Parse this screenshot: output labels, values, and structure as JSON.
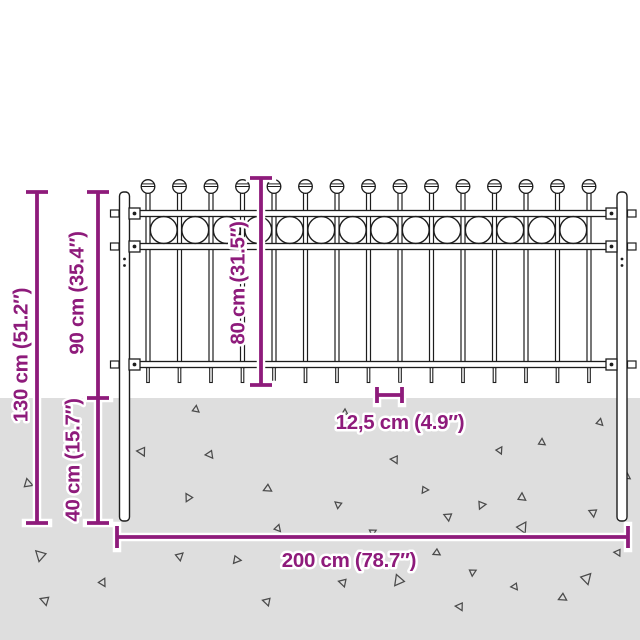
{
  "diagram": {
    "description": "Product dimension drawing of a steel fence panel with ball-top pickets, hoop ornaments, two ground posts and magenta measurement lines",
    "colors": {
      "dimension": "#8E1B7B",
      "outline": "#1d1d1d",
      "ground": "#dedede",
      "background": "#ffffff",
      "speck": "#4a4a4a"
    },
    "labels": {
      "total_height": "130 cm (51.2″)",
      "height_above_ground": "90 cm (35.4″)",
      "panel_height": "80 cm (31.5″)",
      "depth_below_ground": "40 cm (15.7″)",
      "picket_spacing": "12,5 cm (4.9″)",
      "total_width": "200 cm (78.7″)"
    },
    "ground": {
      "top": 398
    },
    "fence": {
      "picket_count": 15,
      "first_picket_x": 148,
      "picket_spacing_px": 31.5,
      "picket_top": 193,
      "ball_cy": 186.5,
      "ball_r": 6.8,
      "rails": [
        {
          "y": 210.5
        },
        {
          "y": 243.5
        },
        {
          "y": 361.5
        }
      ],
      "rail_x": 129,
      "rail_w": 489,
      "rail_h": 6,
      "ring_count": 14,
      "first_ring_x": 163.75,
      "ring_cy": 230,
      "ring_r": 13.4,
      "posts": [
        {
          "name": "left-post",
          "x": 119.5,
          "side": "left"
        },
        {
          "name": "right-post",
          "x": 617,
          "side": "right"
        }
      ],
      "post_top": 192,
      "post_bottom": 521
    },
    "dimensions": [
      {
        "name": "dim-total-height",
        "type": "v",
        "x": 37,
        "y1": 192,
        "y2": 523,
        "tick": 22
      },
      {
        "name": "dim-above-below-ground",
        "type": "v",
        "x": 98,
        "y1": 192,
        "y2": 523,
        "mid": [
          398
        ],
        "tick": 22
      },
      {
        "name": "dim-panel-height",
        "type": "v",
        "x": 261,
        "y1": 178,
        "y2": 385,
        "tick": 22
      },
      {
        "name": "dim-picket-spacing",
        "type": "h",
        "y": 395,
        "x1": 377,
        "x2": 402,
        "tick": 16
      },
      {
        "name": "dim-total-width",
        "type": "h",
        "y": 537,
        "x1": 117,
        "x2": 628,
        "tick": 22
      }
    ],
    "specks": [
      [
        28,
        483,
        9,
        -15
      ],
      [
        40,
        556,
        11,
        190
      ],
      [
        45,
        601,
        9,
        165
      ],
      [
        103,
        582,
        8,
        25
      ],
      [
        142,
        452,
        9,
        150
      ],
      [
        180,
        556,
        8,
        45
      ],
      [
        188,
        498,
        8,
        205
      ],
      [
        196,
        409,
        7,
        5
      ],
      [
        210,
        455,
        8,
        140
      ],
      [
        237,
        560,
        8,
        95
      ],
      [
        268,
        489,
        8,
        120
      ],
      [
        267,
        602,
        8,
        160
      ],
      [
        278,
        528,
        7,
        15
      ],
      [
        345,
        412,
        6,
        0
      ],
      [
        338,
        505,
        7,
        185
      ],
      [
        343,
        583,
        8,
        160
      ],
      [
        373,
        532,
        7,
        60
      ],
      [
        395,
        460,
        8,
        150
      ],
      [
        398,
        581,
        11,
        215
      ],
      [
        425,
        490,
        7,
        90
      ],
      [
        437,
        553,
        7,
        120
      ],
      [
        448,
        517,
        8,
        170
      ],
      [
        460,
        607,
        8,
        150
      ],
      [
        473,
        572,
        7,
        60
      ],
      [
        482,
        505,
        8,
        80
      ],
      [
        500,
        450,
        7,
        30
      ],
      [
        515,
        587,
        7,
        140
      ],
      [
        522,
        497,
        8,
        0
      ],
      [
        523,
        527,
        11,
        30
      ],
      [
        542,
        442,
        7,
        0
      ],
      [
        563,
        598,
        8,
        120
      ],
      [
        587,
        578,
        11,
        40
      ],
      [
        593,
        513,
        8,
        170
      ],
      [
        600,
        422,
        7,
        10
      ],
      [
        618,
        553,
        7,
        150
      ],
      [
        627,
        476,
        7,
        0
      ]
    ]
  }
}
